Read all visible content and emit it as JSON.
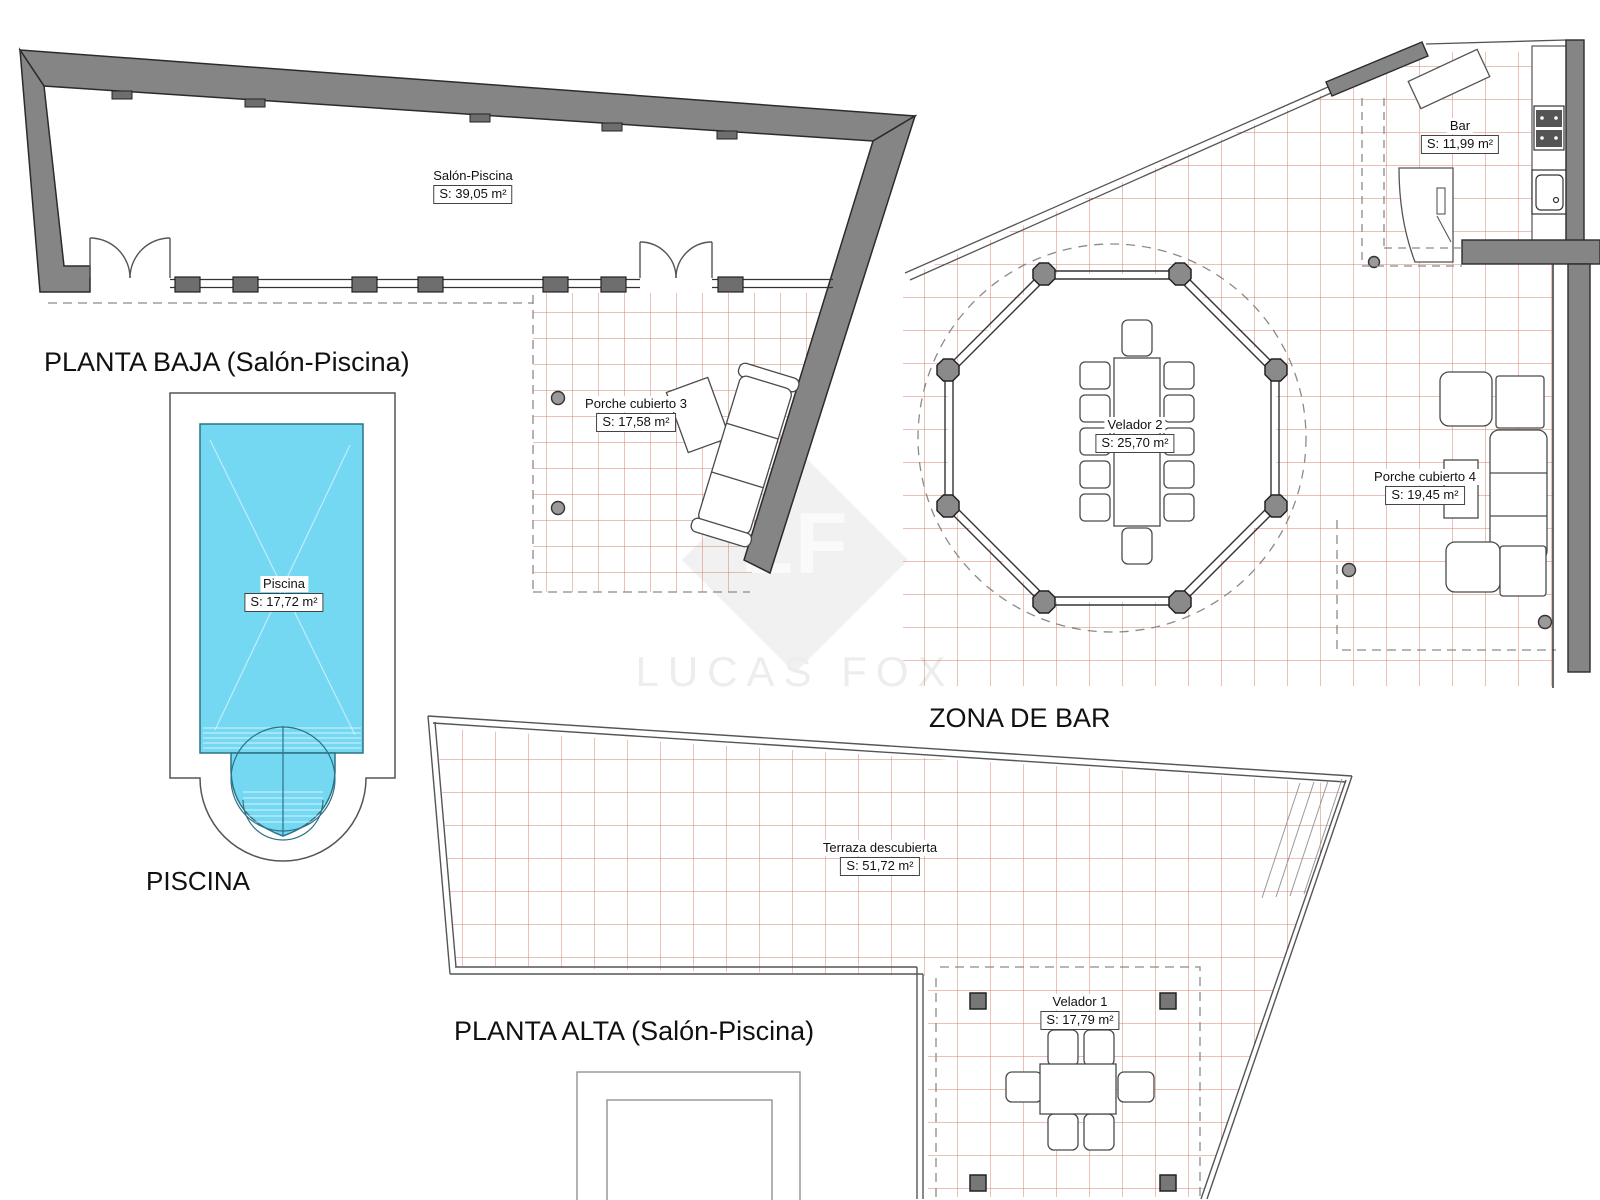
{
  "sections": {
    "planta_baja": {
      "title": "PLANTA BAJA (Salón-Piscina)"
    },
    "piscina": {
      "title": "PISCINA"
    },
    "zona_bar": {
      "title": "ZONA DE BAR"
    },
    "planta_alta": {
      "title": "PLANTA ALTA (Salón-Piscina)"
    }
  },
  "rooms": {
    "salon_piscina": {
      "name": "Salón-Piscina",
      "area": "S: 39,05 m²"
    },
    "porche3": {
      "name": "Porche cubierto 3",
      "area": "S: 17,58 m²"
    },
    "piscina": {
      "name": "Piscina",
      "area": "S: 17,72 m²"
    },
    "bar": {
      "name": "Bar",
      "area": "S: 11,99 m²"
    },
    "velador2": {
      "name": "Velador 2",
      "area": "S: 25,70 m²"
    },
    "porche4": {
      "name": "Porche cubierto 4",
      "area": "S: 19,45 m²"
    },
    "terraza": {
      "name": "Terraza descubierta",
      "area": "S: 51,72 m²"
    },
    "velador1": {
      "name": "Velador 1",
      "area": "S: 17,79 m²"
    }
  },
  "watermark": {
    "initials": "LF",
    "name": "LUCAS FOX"
  },
  "colors": {
    "wall": "#858585",
    "wall_edge": "#2b2b2b",
    "tile_line": "#d5826f",
    "pool_fill": "#74d8f3",
    "pool_edge": "#2d7285",
    "dashed": "#8a8a8a",
    "furniture_edge": "#4a4a4a"
  }
}
